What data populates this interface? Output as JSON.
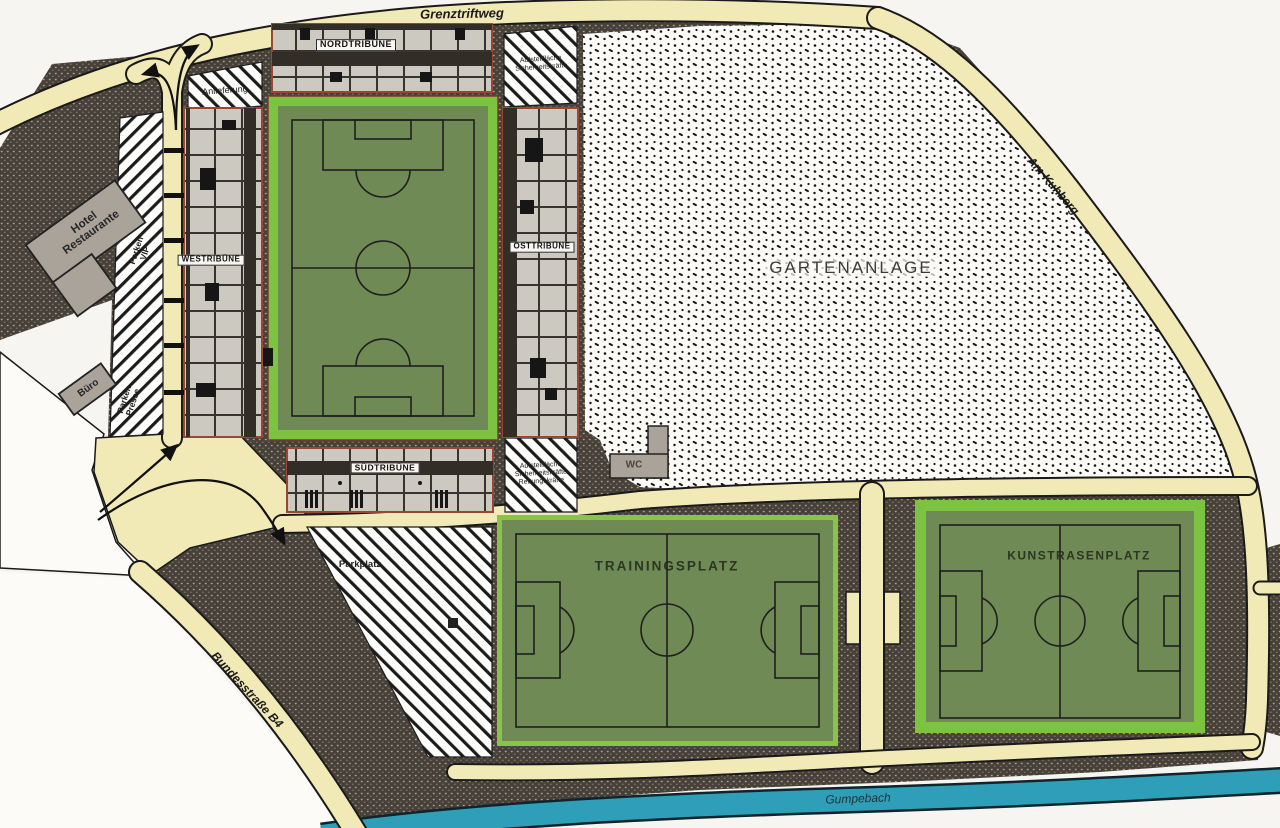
{
  "map_title": "Stadion-Lageplan",
  "roads": {
    "top": "Grenztriftweg",
    "right": "Am Kuhberg",
    "southwest": "Bundesstraße B4"
  },
  "river": {
    "name": "Gumpebach"
  },
  "stadium": {
    "north_stand": "NORDTRIBÜNE",
    "west_stand": "WESTRIBÜNE",
    "east_stand": "OSTTRIBÜNE",
    "south_stand": "SÜDTRIBÜNE"
  },
  "areas": {
    "garden": "GARTENANLAGE",
    "training_pitch": "TRAININGSPLATZ",
    "artificial_turf_pitch": "KUNSTRASENPLATZ",
    "parking_lot": "Parkplatz",
    "delivery": "Anlieferung",
    "staging_north": {
      "line1": "Aufstellfläche",
      "line2": "Sicherheitskräfte"
    },
    "staging_south": {
      "line1": "Aufstellfläche",
      "line2": "Sicherheitskräfte",
      "line3": "Rettungskräfte"
    },
    "parking_vip": {
      "line1": "Parken",
      "line2": "VIP"
    },
    "parking_press": {
      "line1": "Parken",
      "line2": "Presse"
    }
  },
  "buildings": {
    "hotel": {
      "line1": "Hotel",
      "line2": "Restaurante"
    },
    "office": "Büro",
    "wc": "WC"
  },
  "colors": {
    "paper": "#f7f5f1",
    "road_cream": "#f1e9b6",
    "dark_texture": "#474039",
    "garden_dots": "#151515",
    "pitch_green": "#6f8a54",
    "pitch_border_green": "#7cc342",
    "stand_gray": "#ccc9c1",
    "stand_accent_redbrown": "#9a4632",
    "building_gray": "#a9a39a",
    "river_teal": "#2f9fb9"
  }
}
